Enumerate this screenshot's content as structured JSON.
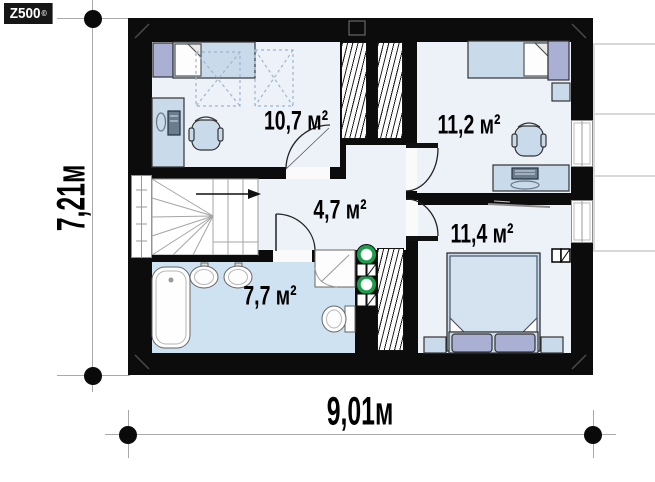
{
  "logo": {
    "brand": "Z500",
    "copyright": "©"
  },
  "dimensions": {
    "width_label": "9,01м",
    "height_label": "7,21м"
  },
  "rooms": {
    "bedroom_top_left": {
      "area": "10,7 м²"
    },
    "bedroom_top_right": {
      "area": "11,2 м²"
    },
    "hall": {
      "area": "4,7 м²"
    },
    "bedroom_bottom_right": {
      "area": "11,4 м²"
    },
    "bathroom": {
      "area": "7,7 м²"
    }
  },
  "colors": {
    "wall": "#0c0c0c",
    "floor": "#edf2f8",
    "bathroom_floor": "#cfe2f2",
    "furniture": "#c9dbeb",
    "wardrobe": "#aab0d4",
    "vent_green": "#1b9e4b",
    "dimension_line": "#a9a9a9"
  }
}
